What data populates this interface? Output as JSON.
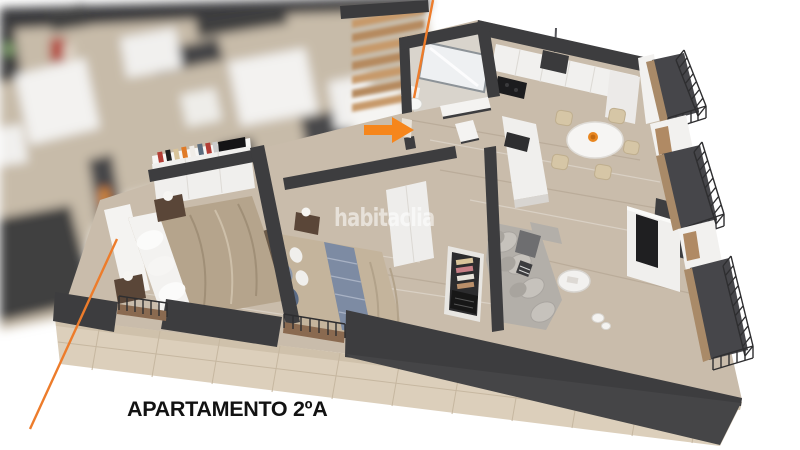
{
  "meta": {
    "description": "3D axonometric floor plan render of an apartment (real-estate listing image)",
    "canvas": "800x450"
  },
  "texts": {
    "watermark": "habitaclia",
    "apartment_label": "APARTAMENTO 2ºA"
  },
  "icons": {
    "entrance_arrow": "orange right-pointing arrow marking the apartment entrance",
    "boundary_line_top": "orange diagonal line at stairwell boundary",
    "boundary_line_left": "orange diagonal line at left apartment boundary"
  },
  "colors": {
    "accent_orange": "#F6861C",
    "boundary_line_orange": "#ED7C2B",
    "wall_charcoal": "#3D3D3F",
    "floor_wood": "#C9BCAB",
    "stone_facade": "#DCCFBB",
    "watermark_white": "#FFFFFF",
    "label_black": "#121212"
  }
}
